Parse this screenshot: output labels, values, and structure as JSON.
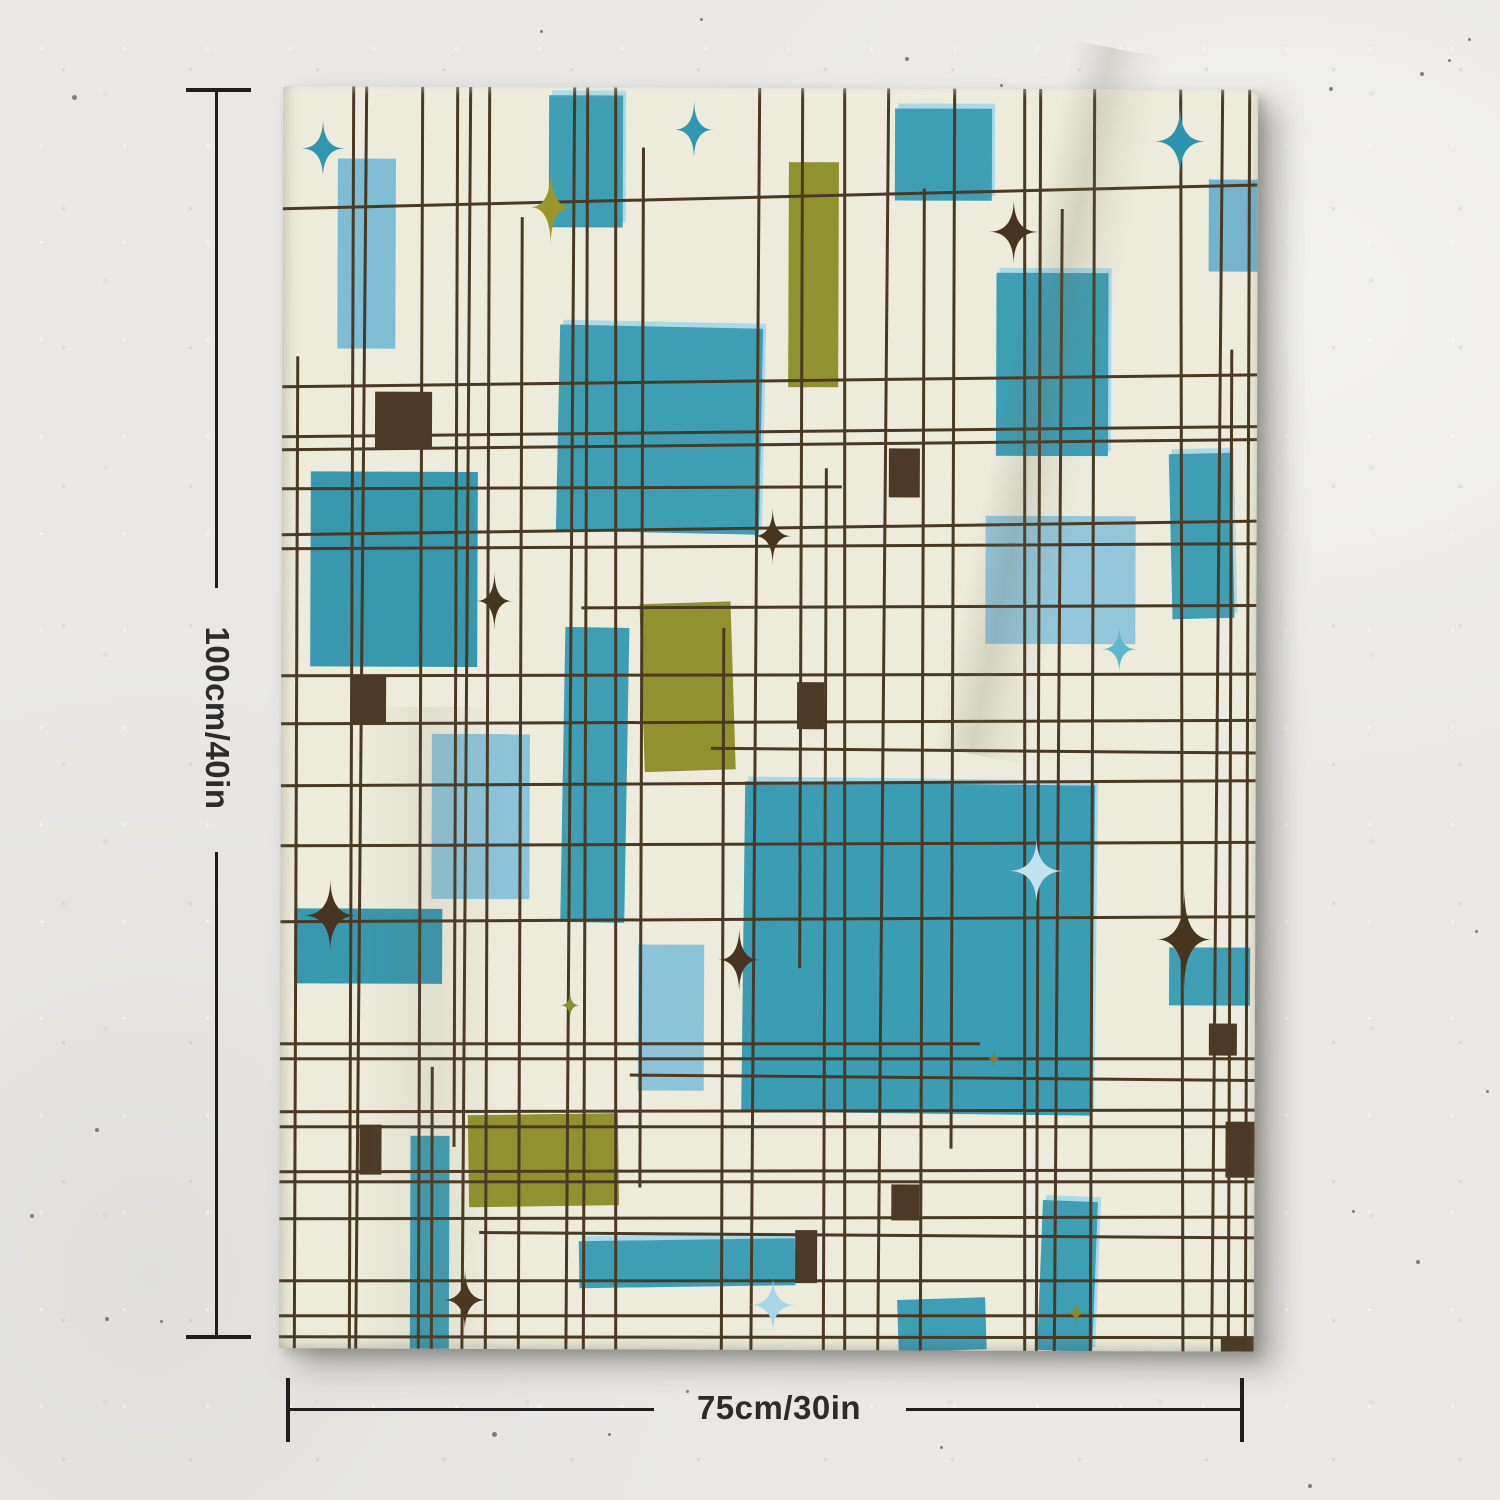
{
  "scene": {
    "wall_color": "#e9e8e6",
    "dimension_annotations": {
      "height_label": "100cm/40in",
      "width_label": "75cm/30in",
      "line_color": "#1e1e1e",
      "text_color": "#2c2c2c"
    },
    "wall_specks": [
      [
        72,
        95,
        5
      ],
      [
        905,
        57,
        4
      ],
      [
        1000,
        84,
        3
      ],
      [
        1329,
        87,
        4
      ],
      [
        1420,
        72,
        4
      ],
      [
        1448,
        59,
        3
      ],
      [
        1468,
        38,
        3
      ],
      [
        540,
        30,
        3
      ],
      [
        700,
        18,
        3
      ],
      [
        95,
        1128,
        4
      ],
      [
        30,
        1214,
        4
      ],
      [
        105,
        1317,
        4
      ],
      [
        160,
        1320,
        3
      ],
      [
        492,
        1432,
        5
      ],
      [
        608,
        1433,
        3
      ],
      [
        686,
        1390,
        3
      ],
      [
        1124,
        1211,
        5
      ],
      [
        1160,
        1345,
        4
      ],
      [
        1308,
        1484,
        4
      ],
      [
        940,
        1446,
        3
      ],
      [
        1352,
        1210,
        3
      ],
      [
        1416,
        1260,
        4
      ],
      [
        1475,
        930,
        3
      ],
      [
        1486,
        1090,
        3
      ]
    ]
  },
  "tapestry": {
    "background": "#edecdc",
    "grid_color": "#4a3a24",
    "grid_width": 3,
    "node_color": "#4a3a26",
    "halo_color": "#abd9e7",
    "palette": {
      "teal": "#3d9eb4",
      "teal_dark": "#3898ae",
      "light_blue": "#8cc3d9",
      "pale_blue": "#93c6da",
      "medium_blue": "#74b3cd",
      "olive": "#8f922e",
      "brown": "#46351f",
      "cream": "#edecdc"
    },
    "blocks": [
      {
        "x": 55,
        "y": 72,
        "w": 58,
        "h": 190,
        "c": "#7fbcd6"
      },
      {
        "x": 266,
        "y": 8,
        "w": 74,
        "h": 132,
        "c": "#3d9eb4",
        "halo": true
      },
      {
        "x": 612,
        "y": 20,
        "w": 97,
        "h": 92,
        "c": "#3d9eb4",
        "halo": true
      },
      {
        "x": 506,
        "y": 74,
        "w": 50,
        "h": 225,
        "c": "#8f922e"
      },
      {
        "x": 926,
        "y": 90,
        "w": 49,
        "h": 92,
        "c": "#74b3cd"
      },
      {
        "x": 714,
        "y": 184,
        "w": 112,
        "h": 183,
        "c": "#3d9eb4",
        "halo": true
      },
      {
        "x": 276,
        "y": 239,
        "w": 203,
        "h": 206,
        "c": "#3d9eb4",
        "rot": 1,
        "halo": true
      },
      {
        "x": 29,
        "y": 385,
        "w": 167,
        "h": 195,
        "c": "#3898ae"
      },
      {
        "x": 282,
        "y": 540,
        "w": 64,
        "h": 295,
        "c": "#3d9eb4",
        "rot": 0.8
      },
      {
        "x": 361,
        "y": 515,
        "w": 91,
        "h": 168,
        "c": "#8f922e",
        "rot": -2
      },
      {
        "x": 151,
        "y": 647,
        "w": 98,
        "h": 165,
        "c": "#8cc3d9"
      },
      {
        "x": 704,
        "y": 427,
        "w": 150,
        "h": 128,
        "c": "#93c6da"
      },
      {
        "x": 889,
        "y": 364,
        "w": 62,
        "h": 165,
        "c": "#3d9eb4",
        "rot": -1.5,
        "halo": true
      },
      {
        "x": 14,
        "y": 822,
        "w": 148,
        "h": 75,
        "c": "#3898ae"
      },
      {
        "x": 463,
        "y": 695,
        "w": 350,
        "h": 330,
        "c": "#3b9db4",
        "rot": 0.5,
        "halo": true
      },
      {
        "x": 889,
        "y": 858,
        "w": 81,
        "h": 58,
        "c": "#3d9eb4"
      },
      {
        "x": 358,
        "y": 857,
        "w": 66,
        "h": 146,
        "c": "#8cc3d9"
      },
      {
        "x": 189,
        "y": 1027,
        "w": 150,
        "h": 92,
        "c": "#8f922e",
        "rot": -1
      },
      {
        "x": 131,
        "y": 1049,
        "w": 39,
        "h": 213,
        "c": "#3d9eb4"
      },
      {
        "x": 300,
        "y": 1152,
        "w": 216,
        "h": 47,
        "c": "#3d9eb4",
        "rot": -1,
        "halo": true
      },
      {
        "x": 761,
        "y": 1112,
        "w": 55,
        "h": 150,
        "c": "#3d9eb4",
        "rot": 2,
        "halo": true
      },
      {
        "x": 619,
        "y": 1210,
        "w": 88,
        "h": 52,
        "c": "#3d9eb4",
        "rot": -2
      }
    ],
    "vlines": [
      {
        "x": 15,
        "y0": 270,
        "y1": 1262
      },
      {
        "x": 70,
        "y0": 0,
        "y1": 1262
      },
      {
        "x": 83,
        "y0": 0,
        "y1": 1262,
        "tilt": 0.3
      },
      {
        "x": 139,
        "y0": 0,
        "y1": 1262
      },
      {
        "x": 152,
        "y0": 980,
        "y1": 1262
      },
      {
        "x": 174,
        "y0": 0,
        "y1": 1060
      },
      {
        "x": 187,
        "y0": 0,
        "y1": 1262,
        "tilt": 0.2
      },
      {
        "x": 206,
        "y0": 0,
        "y1": 1262
      },
      {
        "x": 239,
        "y0": 130,
        "y1": 1262
      },
      {
        "x": 291,
        "y0": 0,
        "y1": 1262,
        "tilt": 0.2
      },
      {
        "x": 304,
        "y0": 0,
        "y1": 1262
      },
      {
        "x": 332,
        "y0": 0,
        "y1": 1262,
        "tilt": -0.2
      },
      {
        "x": 360,
        "y0": 60,
        "y1": 1100
      },
      {
        "x": 442,
        "y0": 540,
        "y1": 1262
      },
      {
        "x": 476,
        "y0": 0,
        "y1": 1262,
        "tilt": 0.2
      },
      {
        "x": 519,
        "y0": 0,
        "y1": 880
      },
      {
        "x": 544,
        "y0": 380,
        "y1": 1262
      },
      {
        "x": 561,
        "y0": 0,
        "y1": 1262,
        "tilt": -0.2
      },
      {
        "x": 605,
        "y0": 0,
        "y1": 1262,
        "tilt": 0.3
      },
      {
        "x": 641,
        "y0": 100,
        "y1": 1262
      },
      {
        "x": 671,
        "y0": 0,
        "y1": 1060
      },
      {
        "x": 741,
        "y0": 0,
        "y1": 1262,
        "tilt": -0.2
      },
      {
        "x": 757,
        "y0": 0,
        "y1": 1262
      },
      {
        "x": 779,
        "y0": 120,
        "y1": 1262,
        "tilt": 0.2
      },
      {
        "x": 811,
        "y0": 0,
        "y1": 1262
      },
      {
        "x": 897,
        "y0": 0,
        "y1": 1262,
        "tilt": -0.3
      },
      {
        "x": 939,
        "y0": 0,
        "y1": 1262,
        "tilt": 0.3
      },
      {
        "x": 949,
        "y0": 260,
        "y1": 1262
      },
      {
        "x": 966,
        "y0": 0,
        "y1": 1262
      }
    ],
    "hlines": [
      {
        "y": 122,
        "x0": 0,
        "x1": 975,
        "tilt": -1.6
      },
      {
        "y": 300,
        "x0": 0,
        "x1": 975,
        "tilt": -0.9
      },
      {
        "y": 350,
        "x0": 0,
        "x1": 975,
        "tilt": -0.8
      },
      {
        "y": 363,
        "x0": 0,
        "x1": 975,
        "tilt": -0.8
      },
      {
        "y": 402,
        "x0": 0,
        "x1": 560,
        "tilt": -0.4
      },
      {
        "y": 448,
        "x0": 0,
        "x1": 975,
        "tilt": -1.0
      },
      {
        "y": 462,
        "x0": 0,
        "x1": 975,
        "tilt": -0.5
      },
      {
        "y": 520,
        "x0": 300,
        "x1": 975,
        "tilt": -0.4
      },
      {
        "y": 589,
        "x0": 0,
        "x1": 975,
        "tilt": -0.3
      },
      {
        "y": 637,
        "x0": 0,
        "x1": 975,
        "tilt": -0.4
      },
      {
        "y": 660,
        "x0": 430,
        "x1": 975,
        "tilt": 0.3
      },
      {
        "y": 699,
        "x0": 0,
        "x1": 975,
        "tilt": -0.5
      },
      {
        "y": 759,
        "x0": 0,
        "x1": 975,
        "tilt": -0.4
      },
      {
        "y": 835,
        "x0": 0,
        "x1": 975,
        "tilt": -0.5
      },
      {
        "y": 957,
        "x0": 0,
        "x1": 700,
        "tilt": -0.2
      },
      {
        "y": 972,
        "x0": 0,
        "x1": 975,
        "tilt": -0.2
      },
      {
        "y": 987,
        "x0": 350,
        "x1": 975,
        "tilt": 0.3
      },
      {
        "y": 1025,
        "x0": 0,
        "x1": 975,
        "tilt": -0.3
      },
      {
        "y": 1040,
        "x0": 0,
        "x1": 975,
        "tilt": -0.2
      },
      {
        "y": 1085,
        "x0": 0,
        "x1": 975,
        "tilt": -0.3
      },
      {
        "y": 1095,
        "x0": 0,
        "x1": 975,
        "tilt": -0.2
      },
      {
        "y": 1132,
        "x0": 0,
        "x1": 975,
        "tilt": -0.3
      },
      {
        "y": 1145,
        "x0": 200,
        "x1": 975,
        "tilt": 0.2
      },
      {
        "y": 1194,
        "x0": 0,
        "x1": 975,
        "tilt": -0.2
      },
      {
        "y": 1229,
        "x0": 0,
        "x1": 975,
        "tilt": -0.2
      },
      {
        "y": 1250,
        "x0": 0,
        "x1": 975,
        "tilt": -0.15
      }
    ],
    "nodes": [
      {
        "x": 93,
        "y": 305,
        "w": 57,
        "h": 57
      },
      {
        "x": 607,
        "y": 360,
        "w": 31,
        "h": 49
      },
      {
        "x": 71,
        "y": 590,
        "w": 34,
        "h": 47
      },
      {
        "x": 516,
        "y": 594,
        "w": 27,
        "h": 47
      },
      {
        "x": 80,
        "y": 1038,
        "w": 22,
        "h": 50
      },
      {
        "x": 612,
        "y": 1096,
        "w": 28,
        "h": 36
      },
      {
        "x": 516,
        "y": 1142,
        "w": 22,
        "h": 53
      },
      {
        "x": 929,
        "y": 934,
        "w": 28,
        "h": 32
      },
      {
        "x": 946,
        "y": 1032,
        "w": 29,
        "h": 56
      },
      {
        "x": 942,
        "y": 1247,
        "w": 33,
        "h": 15
      }
    ],
    "starbursts": [
      {
        "cx": 40,
        "cy": 62,
        "rx": 22,
        "ry": 30,
        "c": "#2f98af"
      },
      {
        "cx": 411,
        "cy": 42,
        "rx": 20,
        "ry": 30,
        "c": "#2f98af"
      },
      {
        "cx": 268,
        "cy": 120,
        "rx": 21,
        "ry": 39,
        "c": "#999729"
      },
      {
        "cx": 731,
        "cy": 143,
        "rx": 25,
        "ry": 33,
        "c": "#46351f"
      },
      {
        "cx": 897,
        "cy": 52,
        "rx": 26,
        "ry": 35,
        "c": "#2c94ac"
      },
      {
        "cx": 213,
        "cy": 514,
        "rx": 18,
        "ry": 30,
        "c": "#46351f"
      },
      {
        "cx": 491,
        "cy": 448,
        "rx": 19,
        "ry": 29,
        "c": "#46351f"
      },
      {
        "cx": 838,
        "cy": 560,
        "rx": 18,
        "ry": 24,
        "c": "#60b7cc"
      },
      {
        "cx": 50,
        "cy": 829,
        "rx": 27,
        "ry": 37,
        "c": "#46351f"
      },
      {
        "cx": 459,
        "cy": 872,
        "rx": 21,
        "ry": 33,
        "c": "#46351f"
      },
      {
        "cx": 756,
        "cy": 782,
        "rx": 28,
        "ry": 34,
        "c": "#c3e2ee"
      },
      {
        "cx": 904,
        "cy": 850,
        "rx": 28,
        "ry": 50,
        "c": "#46351f"
      },
      {
        "cx": 714,
        "cy": 970,
        "rx": 7,
        "ry": 10,
        "c": "#8a7d26"
      },
      {
        "cx": 186,
        "cy": 1213,
        "rx": 22,
        "ry": 31,
        "c": "#46351f"
      },
      {
        "cx": 494,
        "cy": 1217,
        "rx": 24,
        "ry": 28,
        "c": "#a9d6e6"
      },
      {
        "cx": 797,
        "cy": 1224,
        "rx": 10,
        "ry": 13,
        "c": "#8a8b2a"
      },
      {
        "cx": 290,
        "cy": 918,
        "rx": 10,
        "ry": 14,
        "c": "#8a8b2a"
      }
    ]
  }
}
